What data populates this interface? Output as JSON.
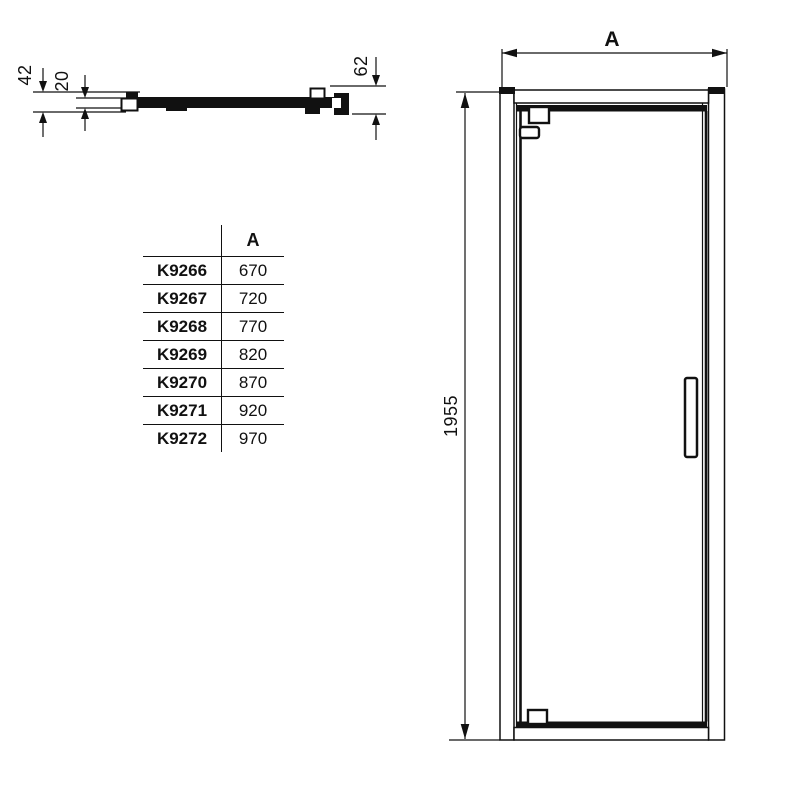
{
  "section_view": {
    "dim_total_depth": "42",
    "dim_inner_depth": "20",
    "dim_profile_height": "62"
  },
  "elevation_view": {
    "dim_width_label": "A",
    "dim_height": "1955"
  },
  "size_table": {
    "header": {
      "code": "",
      "a": "A"
    },
    "rows": [
      {
        "code": "K9266",
        "a": "670"
      },
      {
        "code": "K9267",
        "a": "720"
      },
      {
        "code": "K9268",
        "a": "770"
      },
      {
        "code": "K9269",
        "a": "820"
      },
      {
        "code": "K9270",
        "a": "870"
      },
      {
        "code": "K9271",
        "a": "920"
      },
      {
        "code": "K9272",
        "a": "970"
      }
    ]
  },
  "colors": {
    "line": "#111111",
    "background": "#ffffff"
  }
}
